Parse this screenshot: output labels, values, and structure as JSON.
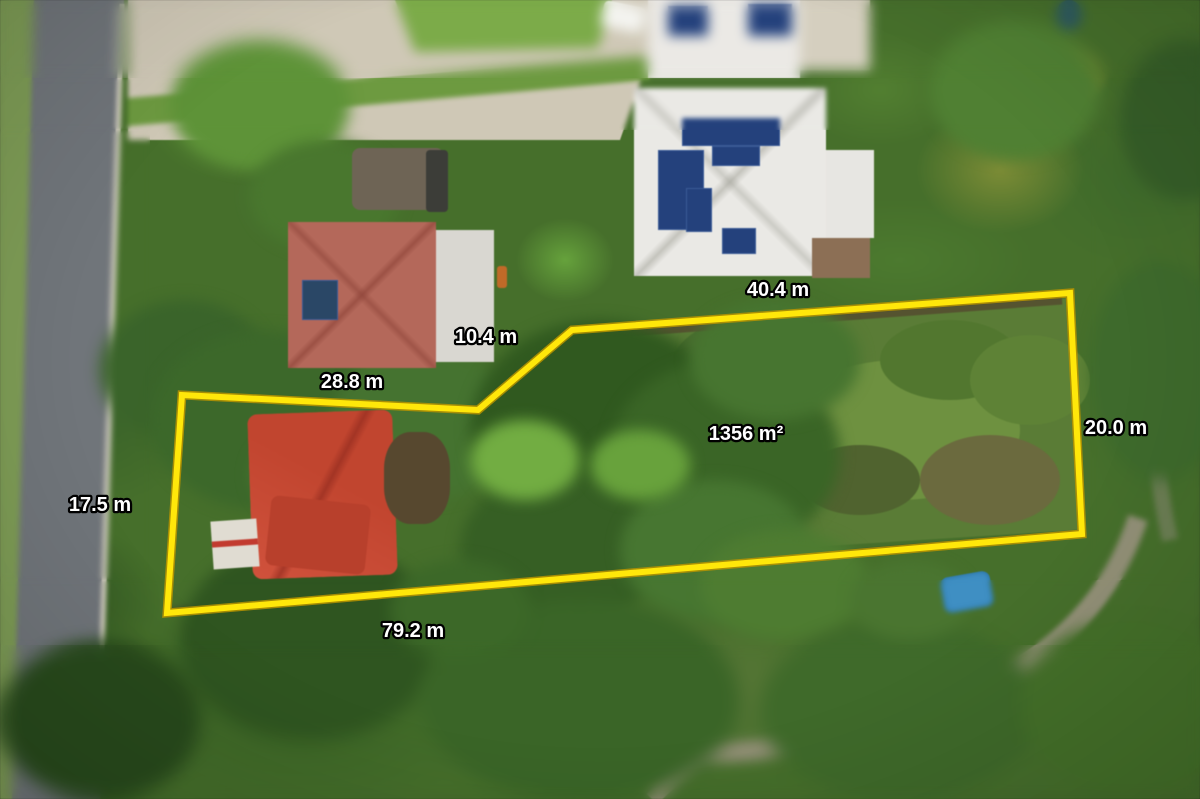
{
  "scene": {
    "description_label": "aerial-property-photo"
  },
  "boundary": {
    "color": "#ffe70a",
    "polygon_points": "167,613 182,395 478,410 572,330 1070,293 1082,534"
  },
  "dimension_labels": [
    {
      "side": "top",
      "text": "40.4 m"
    },
    {
      "side": "upper-diagonal",
      "text": "10.4 m"
    },
    {
      "side": "upper-left",
      "text": "28.8 m"
    },
    {
      "side": "right",
      "text": "20.0 m"
    },
    {
      "side": "left",
      "text": "17.5 m"
    },
    {
      "side": "bottom",
      "text": "79.2 m"
    }
  ],
  "area_label": {
    "text": "1356 m²"
  },
  "colors": {
    "label_text": "#ffffff",
    "label_outline": "#000000",
    "boundary_yellow": "#ffe70a"
  }
}
